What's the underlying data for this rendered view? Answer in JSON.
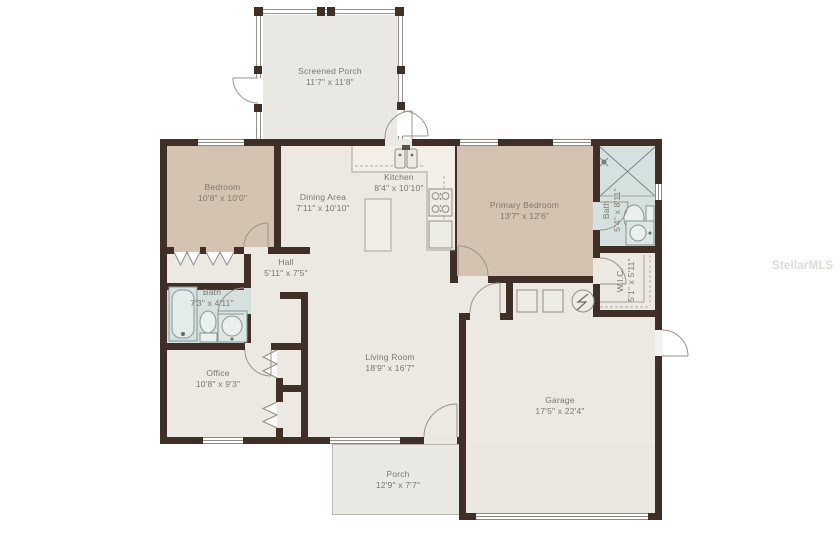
{
  "watermark": "StellarMLS",
  "colors": {
    "wall": "#402f27",
    "floor": "#ece9e2",
    "bedroom_floor": "#d5c3b1",
    "bath_floor": "#d4e1df",
    "porch_floor": "#e9e8e3",
    "label_text": "#7e766c"
  },
  "rooms": {
    "screened_porch": {
      "name": "Screened Porch",
      "dims": "11'7\" x 11'8\""
    },
    "bedroom": {
      "name": "Bedroom",
      "dims": "10'8\" x 10'0\""
    },
    "dining_area": {
      "name": "Dining Area",
      "dims": "7'11\" x 10'10\""
    },
    "kitchen": {
      "name": "Kitchen",
      "dims": "8'4\" x 10'10\""
    },
    "primary_bedroom": {
      "name": "Primary Bedroom",
      "dims": "13'7\" x 12'6\""
    },
    "bath": {
      "name": "Bath",
      "dims": "5'4\" x 8'11\""
    },
    "wic": {
      "name": "W.I.C.",
      "dims": "5'1\" x 5'11\""
    },
    "hall": {
      "name": "Hall",
      "dims": "5'11\" x 7'5\""
    },
    "bath2": {
      "name": "Bath",
      "dims": "7'3\" x 4'11\""
    },
    "office": {
      "name": "Office",
      "dims": "10'8\" x 9'3\""
    },
    "living_room": {
      "name": "Living Room",
      "dims": "18'9\" x 16'7\""
    },
    "garage": {
      "name": "Garage",
      "dims": "17'5\" x 22'4\""
    },
    "porch": {
      "name": "Porch",
      "dims": "12'9\" x 7'7\""
    }
  }
}
